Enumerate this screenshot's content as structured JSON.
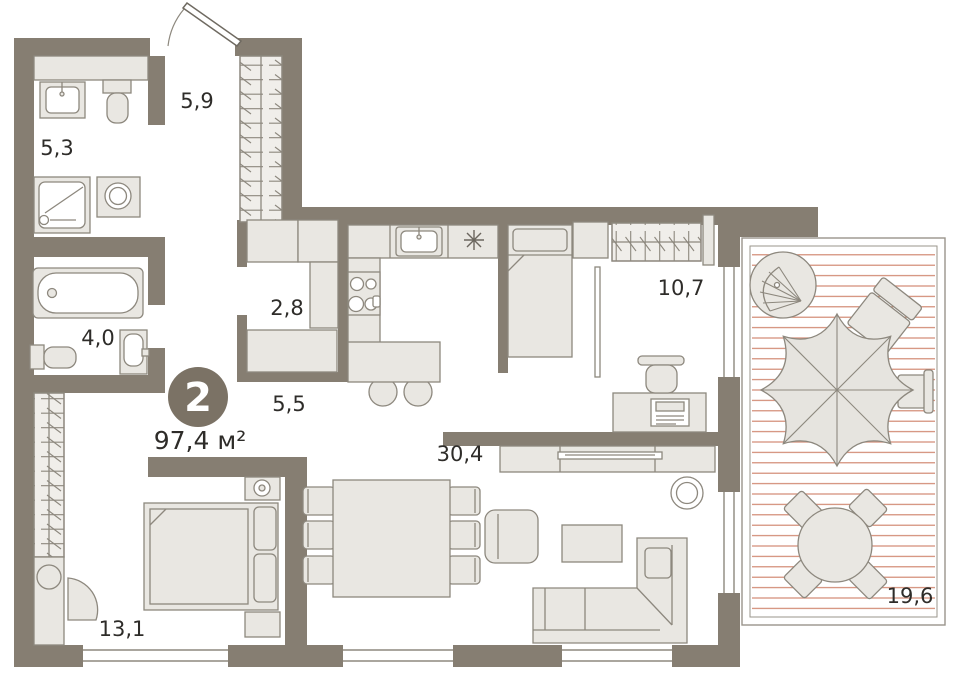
{
  "plan": {
    "type": "apartment-floor-plan",
    "badge": {
      "rooms": "2",
      "area": "97,4 м²"
    },
    "rooms": [
      {
        "id": "bathroom-top",
        "area": "5,3"
      },
      {
        "id": "entry-hall",
        "area": "5,9"
      },
      {
        "id": "closet-hall",
        "area": "2,8"
      },
      {
        "id": "bathroom-main",
        "area": "4,0"
      },
      {
        "id": "corridor",
        "area": "5,5"
      },
      {
        "id": "bedroom-small",
        "area": "10,7"
      },
      {
        "id": "living-kitchen",
        "area": "30,4"
      },
      {
        "id": "bedroom-master",
        "area": "13,1"
      },
      {
        "id": "terrace",
        "area": "19,6"
      }
    ],
    "icons": {
      "fridge": "asterisk-snowflake",
      "stove": "four-burners",
      "wardrobes": "hanger-hatch"
    },
    "colors": {
      "wall": "#867e72",
      "furniture_fill": "#e9e7e2",
      "furniture_stroke": "#8d887e",
      "deck_line": "#cd7f66",
      "badge": "#7b7265",
      "text": "#2e2c29",
      "background": "#ffffff"
    }
  }
}
